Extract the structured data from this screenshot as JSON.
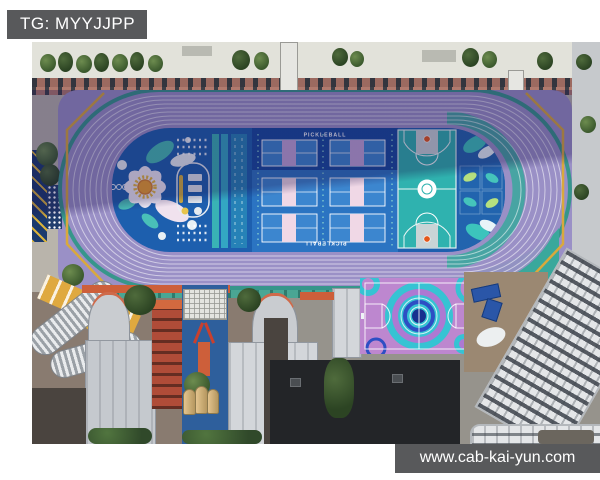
{
  "overlay": {
    "tg_label": "TG: MYYJJPP",
    "watermark": "www.cab-kai-yun.com"
  },
  "scene": {
    "type": "aerial-photograph",
    "subject": "Aerial view of a colorful school sports complex: purple running track around a blue infield with pickleball courts, a teal basketball court, decorative leaf and flower graphics, a purple basketball court with concentric circles, surrounded by school buildings",
    "labels": {
      "pickleball_top": "PICKLEBALL",
      "pickleball_bottom": "PICKLEBALL"
    },
    "colors": {
      "label_bg": "#58595b",
      "track_light": "#9a90c6",
      "track_shadow": "#5d55a0",
      "field_blue": "#1d5fae",
      "pickleball_navy": "#16499d",
      "pickleball_blue": "#2b74c2",
      "court_light_blue": "#3c86cf",
      "stripe_lavender": "#c1a5d8",
      "stripe_pink": "#f0d8e6",
      "basketball_teal": "#2fb2af",
      "rim_orange": "#e2571b",
      "leaf_green": "#b5e07f",
      "leaf_teal": "#45c4bb",
      "leaf_panel_blue": "#2264ae",
      "purple_court": "#bd87cf",
      "ring_teal": "#36c3d3",
      "ring_blue": "#2d4fc4",
      "gold_accent": "#d9a93c",
      "teal_edge": "#3aa89c"
    }
  }
}
